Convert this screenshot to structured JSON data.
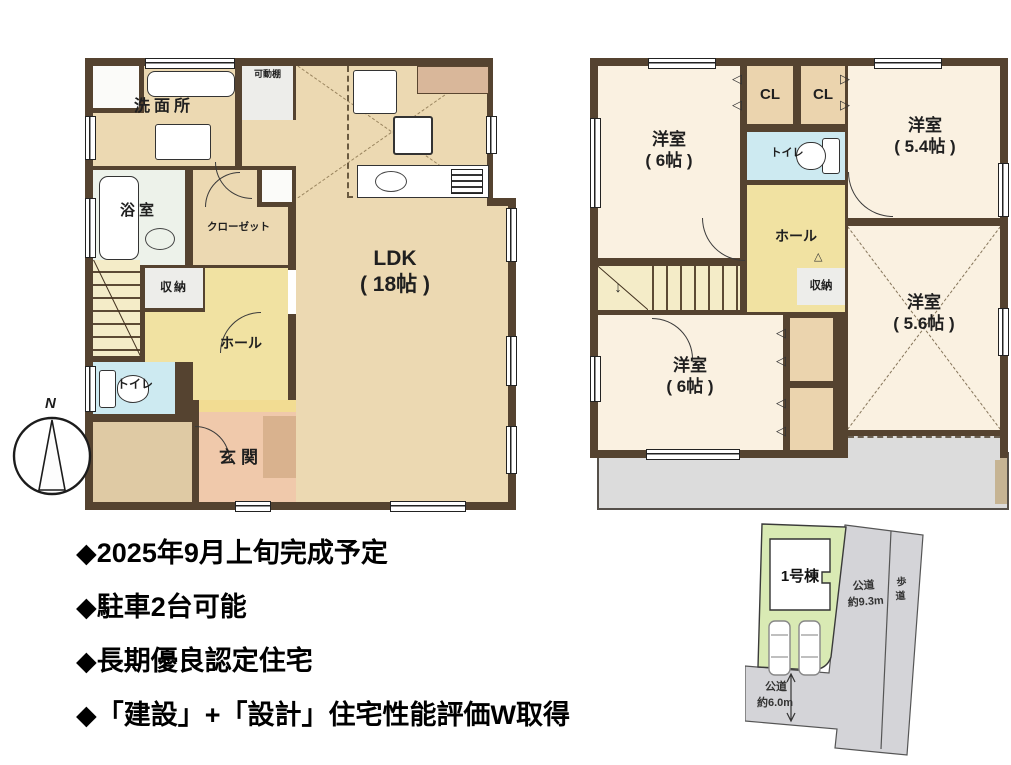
{
  "colors": {
    "wall": "#554330",
    "tan": "#ecd9b2",
    "cream": "#faf1e1",
    "yellow": "#f1e2a2",
    "stair": "#f4ecc8",
    "peach": "#f0c9ab",
    "shoe": "#d9b28e",
    "tanroom": "#dfcaa4",
    "blue": "#cdeaf1",
    "bathc": "#edf2ea",
    "grayroom": "#ededea",
    "whiteroom": "#fbfbf9",
    "cl": "#ebd4ae",
    "balcony": "#dcdcdc",
    "pantry": "#d9b79a",
    "stepc": "#f2dc92",
    "sitegreen": "#d9eab4",
    "siteroad": "#d4d4d8"
  },
  "f1": {
    "washroom": "洗面所",
    "shelf": "可動棚",
    "bath": "浴室",
    "closet": "クローゼット",
    "storage": "収納",
    "toilet": "トイレ",
    "hall": "ホール",
    "entrance": "玄関",
    "ldk": "LDK\n( 18帖 )"
  },
  "f2": {
    "room6a": "洋室\n( 6帖 )",
    "room54": "洋室\n( 5.4帖 )",
    "room56": "洋室\n( 5.6帖 )",
    "room6b": "洋室\n( 6帖 )",
    "cl": "CL",
    "toilet": "トイレ",
    "hall": "ホール",
    "storage": "収納"
  },
  "icons": {
    "stairs_arrow": "↓",
    "tri_left": "◁",
    "tri_right": "▷",
    "tri_up": "△",
    "compass_n": "N"
  },
  "notes": {
    "items": [
      "◆2025年9月上旬完成予定",
      "◆駐車2台可能",
      "◆長期優良認定住宅",
      "◆「建設」+「設計」住宅性能評価W取得"
    ]
  },
  "site": {
    "building": "1号棟",
    "road_side_1": "公道",
    "road_side_2": "約9.3m",
    "sidewalk_1": "歩",
    "sidewalk_2": "道",
    "road_bottom_1": "公道",
    "road_bottom_2": "約6.0m"
  }
}
